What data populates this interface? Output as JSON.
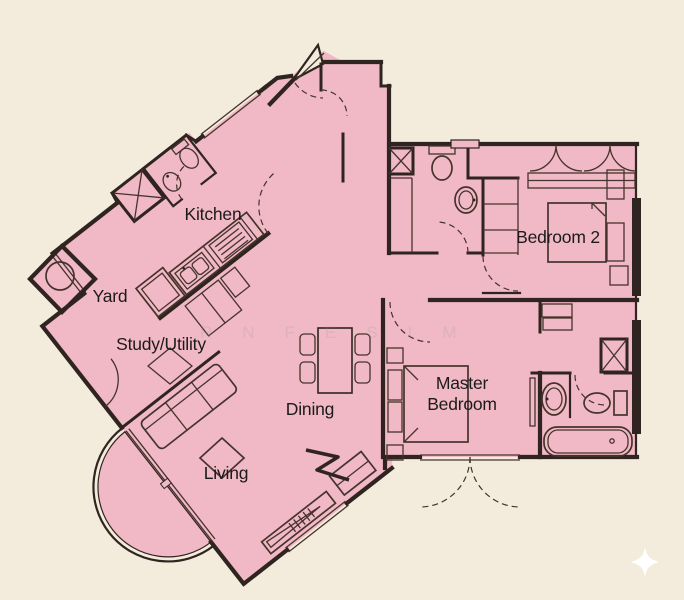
{
  "title": "apartment-floor-plan",
  "rooms": {
    "kitchen": "Kitchen",
    "yard": "Yard",
    "study": "Study/Utility",
    "dining": "Dining",
    "living": "Living",
    "master_line1": "Master",
    "master_line2": "Bedroom",
    "bedroom2": "Bedroom 2"
  },
  "watermark": "RNFESIM",
  "icons": {
    "sparkle": "four-pointed-star"
  },
  "colors": {
    "bg": "#f3ecdc",
    "floor": "#f1b8c6",
    "wall": "#2f241f",
    "thin": "#45342b",
    "text": "#1b1b1b",
    "wm": "#8d939c"
  }
}
